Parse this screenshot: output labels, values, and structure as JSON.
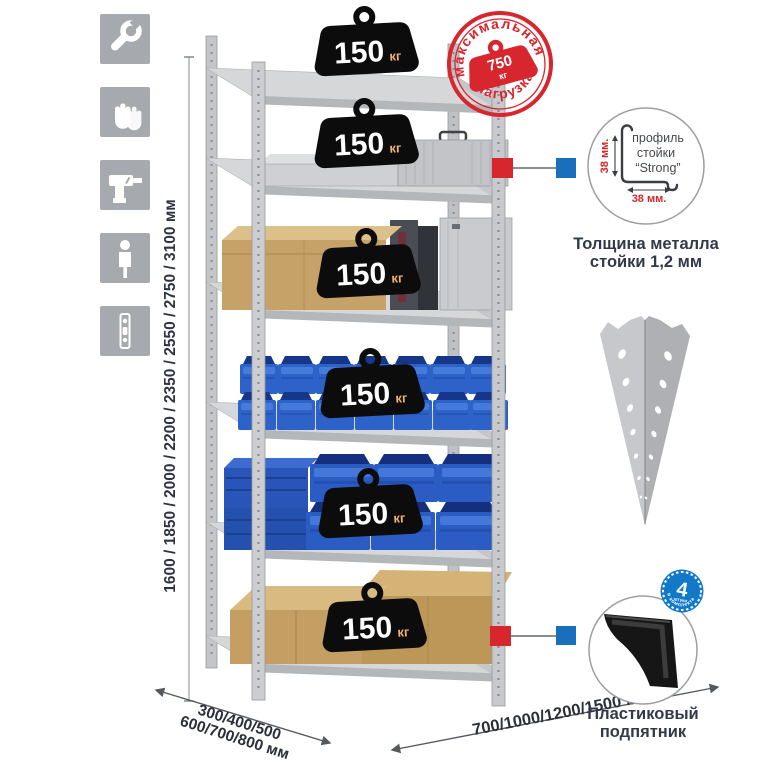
{
  "sidebar": {
    "icons": [
      {
        "name": "wrench"
      },
      {
        "name": "gloves"
      },
      {
        "name": "drill"
      },
      {
        "name": "person"
      },
      {
        "name": "post-profile"
      }
    ]
  },
  "dimensions": {
    "height_label": "1600 / 1850 / 2000 / 2200 / 2350 / 2550 / 2750 / 3100 мм",
    "depth_line1": "300/400/500",
    "depth_line2": "600/700/800 мм",
    "width_label": "700/1000/1200/1500 мм"
  },
  "stamp": {
    "arc_top": "максимальная",
    "arc_bottom": "нагрузка",
    "value": "750",
    "unit": "кг"
  },
  "shelves": [
    {
      "load": "150",
      "unit": "кг"
    },
    {
      "load": "150",
      "unit": "кг"
    },
    {
      "load": "150",
      "unit": "кг"
    },
    {
      "load": "150",
      "unit": "кг"
    },
    {
      "load": "150",
      "unit": "кг"
    },
    {
      "load": "150",
      "unit": "кг"
    }
  ],
  "profile_detail": {
    "label1": "профиль",
    "label2": "стойки",
    "label3": "“Strong”",
    "dim_v": "38 мм.",
    "dim_h": "38 мм.",
    "caption1": "Толщина металла",
    "caption2": "стойки 1,2 мм"
  },
  "foot_detail": {
    "badge_value": "4",
    "badge_small": "штуки",
    "badge_arc": "в комплекте",
    "caption1": "Пластиковый",
    "caption2": "подпятник"
  },
  "colors": {
    "accent_red": "#d7262d",
    "accent_blue": "#1a6fbd",
    "navy_text": "#2e3440",
    "icon_bg": "#a6a9ad",
    "metal": "#c3c5c8",
    "bin_blue": "#2d62c9",
    "cardboard": "#c7a268",
    "badge_black": "#0c0c0c"
  }
}
